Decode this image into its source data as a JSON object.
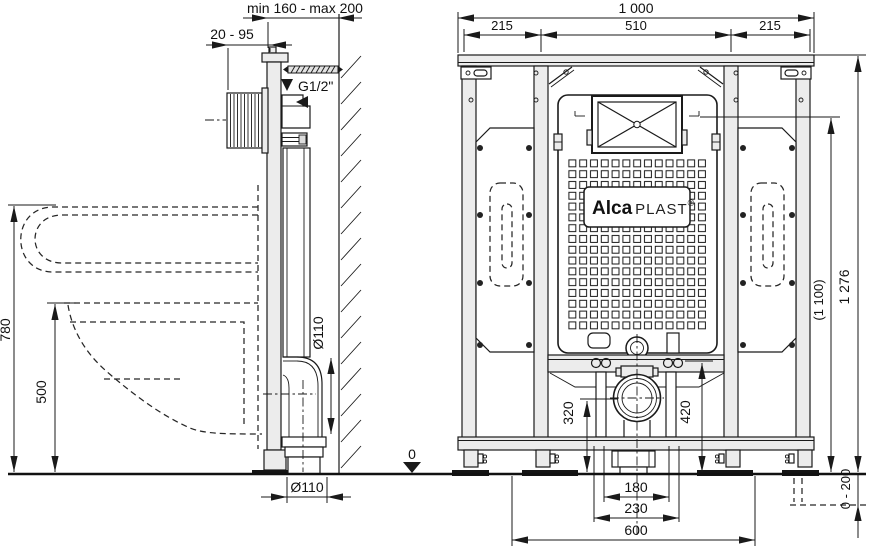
{
  "side": {
    "dim_depth_range": "min 160 - max 200",
    "dim_plate_depth": "20 - 95",
    "supply_thread": "G1/2\"",
    "dim_height_flush": "780",
    "dim_height_bowl": "500",
    "dim_pipe_dia_elbow": "Ø110",
    "dim_pipe_dia_outlet": "Ø110",
    "datum_zero": "0"
  },
  "front": {
    "dim_width_total": "1 000",
    "dim_width_left": "215",
    "dim_width_center": "510",
    "dim_width_right": "215",
    "dim_height_total": "1 276",
    "dim_height_window": "(1 100)",
    "dim_feet_range": "0 - 200",
    "dim_waste_height": "320",
    "dim_rail_height": "420",
    "dim_stud_spacing": "180",
    "dim_anchor_spacing": "230",
    "dim_base_spacing": "600"
  },
  "brand": {
    "bold": "Alca",
    "rest": "PLAST",
    "reg": "®"
  },
  "colors": {
    "line": "#1a1a1a",
    "fill_light": "#ececec",
    "background": "#ffffff"
  }
}
